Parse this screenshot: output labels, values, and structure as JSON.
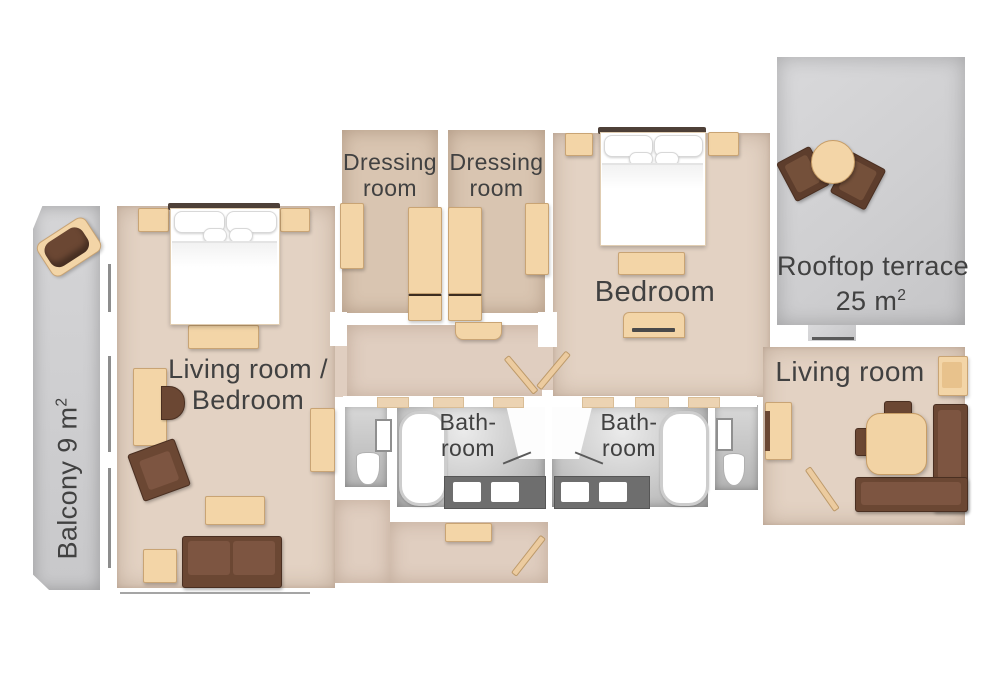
{
  "colors": {
    "floor_beige": "#e3d2c3",
    "floor_dressing": "#d9c5b1",
    "terrace_gray": "#d2d2d4",
    "bathroom_gray": "#bfbfbf",
    "counter_gray": "#6e6e6e",
    "furniture_beige": "#f3d5a7",
    "furniture_brown": "#6b4733",
    "label_text": "#414141"
  },
  "rooms": {
    "balcony": {
      "label": "Balcony 9 m",
      "area_sup": "2"
    },
    "living_bedroom": {
      "label_line1": "Living room /",
      "label_line2": "Bedroom"
    },
    "dressing_left": {
      "label_line1": "Dressing",
      "label_line2": "room"
    },
    "dressing_right": {
      "label_line1": "Dressing",
      "label_line2": "room"
    },
    "bedroom": {
      "label": "Bedroom"
    },
    "rooftop_terrace": {
      "label_line1": "Rooftop terrace",
      "label_line2": "25 m",
      "area_sup": "2"
    },
    "living_room": {
      "label": "Living room"
    },
    "bathroom_left": {
      "label_line1": "Bath-",
      "label_line2": "room"
    },
    "bathroom_right": {
      "label_line1": "Bath-",
      "label_line2": "room"
    }
  }
}
